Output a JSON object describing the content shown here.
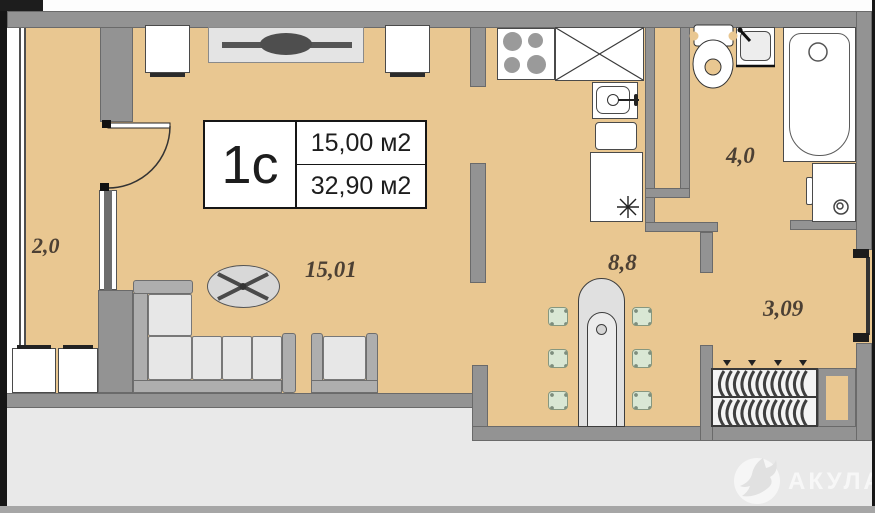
{
  "plan": {
    "unit": {
      "type": "1с",
      "living_area": "15,00 м2",
      "total_area": "32,90 м2"
    },
    "rooms": [
      {
        "name": "balcony",
        "area": "2,0"
      },
      {
        "name": "living-room",
        "area": "15,01"
      },
      {
        "name": "dining-area",
        "area": "8,8"
      },
      {
        "name": "bathroom",
        "area": "4,0"
      },
      {
        "name": "hallway",
        "area": "3,09"
      }
    ],
    "furniture": [
      "cabinet",
      "tv-stand",
      "corner-sofa",
      "coffee-table",
      "armchair",
      "dining-table",
      "chair",
      "balcony-stool",
      "stove",
      "kitchen-counter",
      "kitchen-sink",
      "kitchen-drawer",
      "fridge",
      "toilet",
      "washbasin",
      "bathtub",
      "washing-machine",
      "wardrobe"
    ]
  },
  "watermark": {
    "text": "АКУЛА",
    "icon": "shark-icon"
  },
  "colors": {
    "floor": "#e9c791",
    "wall": "#939393",
    "outside": "#e9e9e9",
    "label_text": "#4c4034"
  }
}
